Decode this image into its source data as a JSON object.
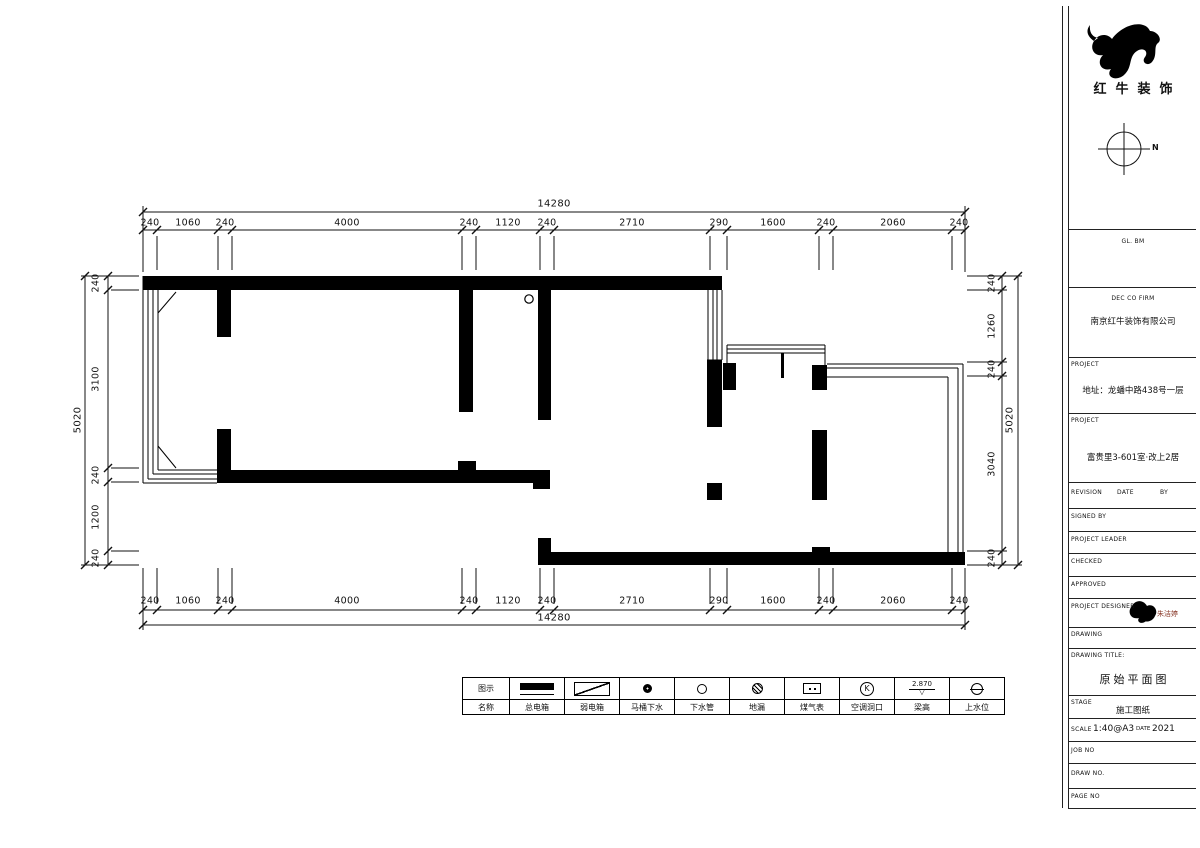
{
  "brand": {
    "company_cn": "红牛装饰"
  },
  "compass": {
    "north_label": "N"
  },
  "title_block": {
    "code_text": "GL. BM",
    "firm_label": "DEC CO FIRM",
    "firm_name": "南京红牛装饰有限公司",
    "project_label_1": "PROJECT",
    "address": "地址：龙蟠中路438号一层",
    "project_label_2": "PROJECT",
    "project_name": "富贵里3-601室·改上2居",
    "revision_label": "REVISION",
    "date_label": "DATE",
    "by_label": "BY",
    "signed_by_label": "SIGNED BY",
    "project_leader_label": "PROJECT LEADER",
    "checked_label": "CHECKED",
    "approved_label": "APPROVED",
    "project_designer_label": "PROJECT DESIGNER",
    "designer_name": "朱洁婷",
    "drawing_label": "DRAWING",
    "drawing_title_label": "DRAWING TITLE:",
    "drawing_title": "原始平面图",
    "stage_label": "STAGE",
    "stage_value": "施工图纸",
    "scale_label": "SCALE",
    "scale_value": "1:40@A3",
    "date_small_label": "DATE",
    "date_value": "2021",
    "job_no_label": "JOB NO",
    "draw_no_label": "DRAW NO.",
    "page_no_label": "PAGE NO"
  },
  "dimensions": {
    "top_total": "14280",
    "bottom_total": "14280",
    "h_segments": [
      "240",
      "1060",
      "240",
      "4000",
      "240",
      "1120",
      "240",
      "2710",
      "290",
      "1600",
      "240",
      "2060",
      "240"
    ],
    "left_total": "5020",
    "right_total": "5020",
    "left_segments": [
      "240",
      "3100",
      "240",
      "1200",
      "240"
    ],
    "right_segments": [
      "240",
      "1260",
      "240",
      "3040",
      "240"
    ]
  },
  "legend": {
    "header_top": "图示",
    "header_bottom": "名称",
    "items": [
      {
        "name": "总电箱",
        "symbol": "main-electric-box"
      },
      {
        "name": "弱电箱",
        "symbol": "weak-electric-box"
      },
      {
        "name": "马桶下水",
        "symbol": "toilet-drain"
      },
      {
        "name": "下水管",
        "symbol": "drain-pipe"
      },
      {
        "name": "地漏",
        "symbol": "floor-drain"
      },
      {
        "name": "煤气表",
        "symbol": "gas-meter"
      },
      {
        "name": "空调洞口",
        "symbol": "ac-hole",
        "letter": "K"
      },
      {
        "name": "梁高",
        "symbol": "beam-elevation",
        "value": "2.870",
        "triangle": "▽"
      },
      {
        "name": "上水位",
        "symbol": "water-supply"
      }
    ]
  }
}
